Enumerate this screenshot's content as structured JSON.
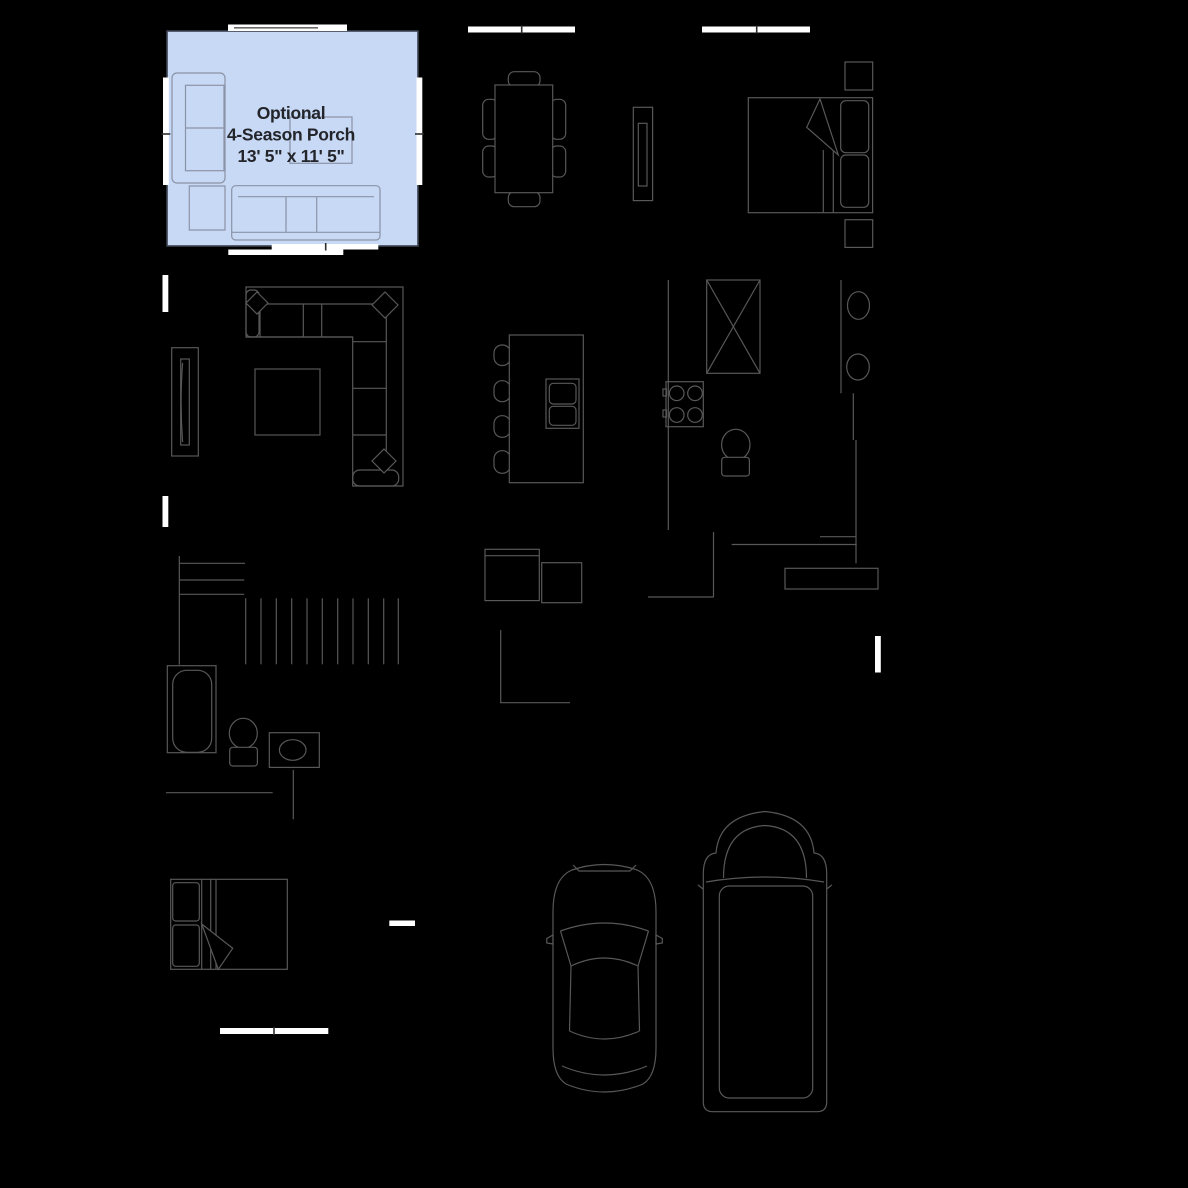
{
  "canvas": {
    "width": 1188,
    "height": 1188
  },
  "palette": {
    "background": "#000000",
    "line": "#585858",
    "window": "#ffffff",
    "tick": "#2e2e2e",
    "porch-fill": "#c7d9f4",
    "porch-line": "#8b93a6",
    "porch-border": "#3a4150",
    "label-text": "#23252b"
  },
  "porch_label": {
    "line1": "Optional",
    "line2": "4-Season Porch",
    "line3": "13' 5\" x 11' 5\""
  },
  "icons": [
    "armchair-icon",
    "side-table-icon",
    "porch-table-icon",
    "sofa-icon",
    "dining-table-icon",
    "dining-chair-icon",
    "sideboard-icon",
    "double-bed-icon",
    "nightstand-icon",
    "sectional-sofa-icon",
    "throw-pillow-icon",
    "coffee-table-icon",
    "tv-console-icon",
    "kitchen-island-icon",
    "bar-stool-icon",
    "island-sink-icon",
    "refrigerator-icon",
    "cooktop-icon",
    "toilet-icon",
    "sink-basin-icon",
    "washer-icon",
    "dryer-icon",
    "stairs-icon",
    "bathtub-icon",
    "vanity-sink-icon",
    "bed-icon",
    "car-icon",
    "pickup-truck-icon",
    "mudroom-bench-icon",
    "window-marker",
    "sliding-door-marker"
  ]
}
